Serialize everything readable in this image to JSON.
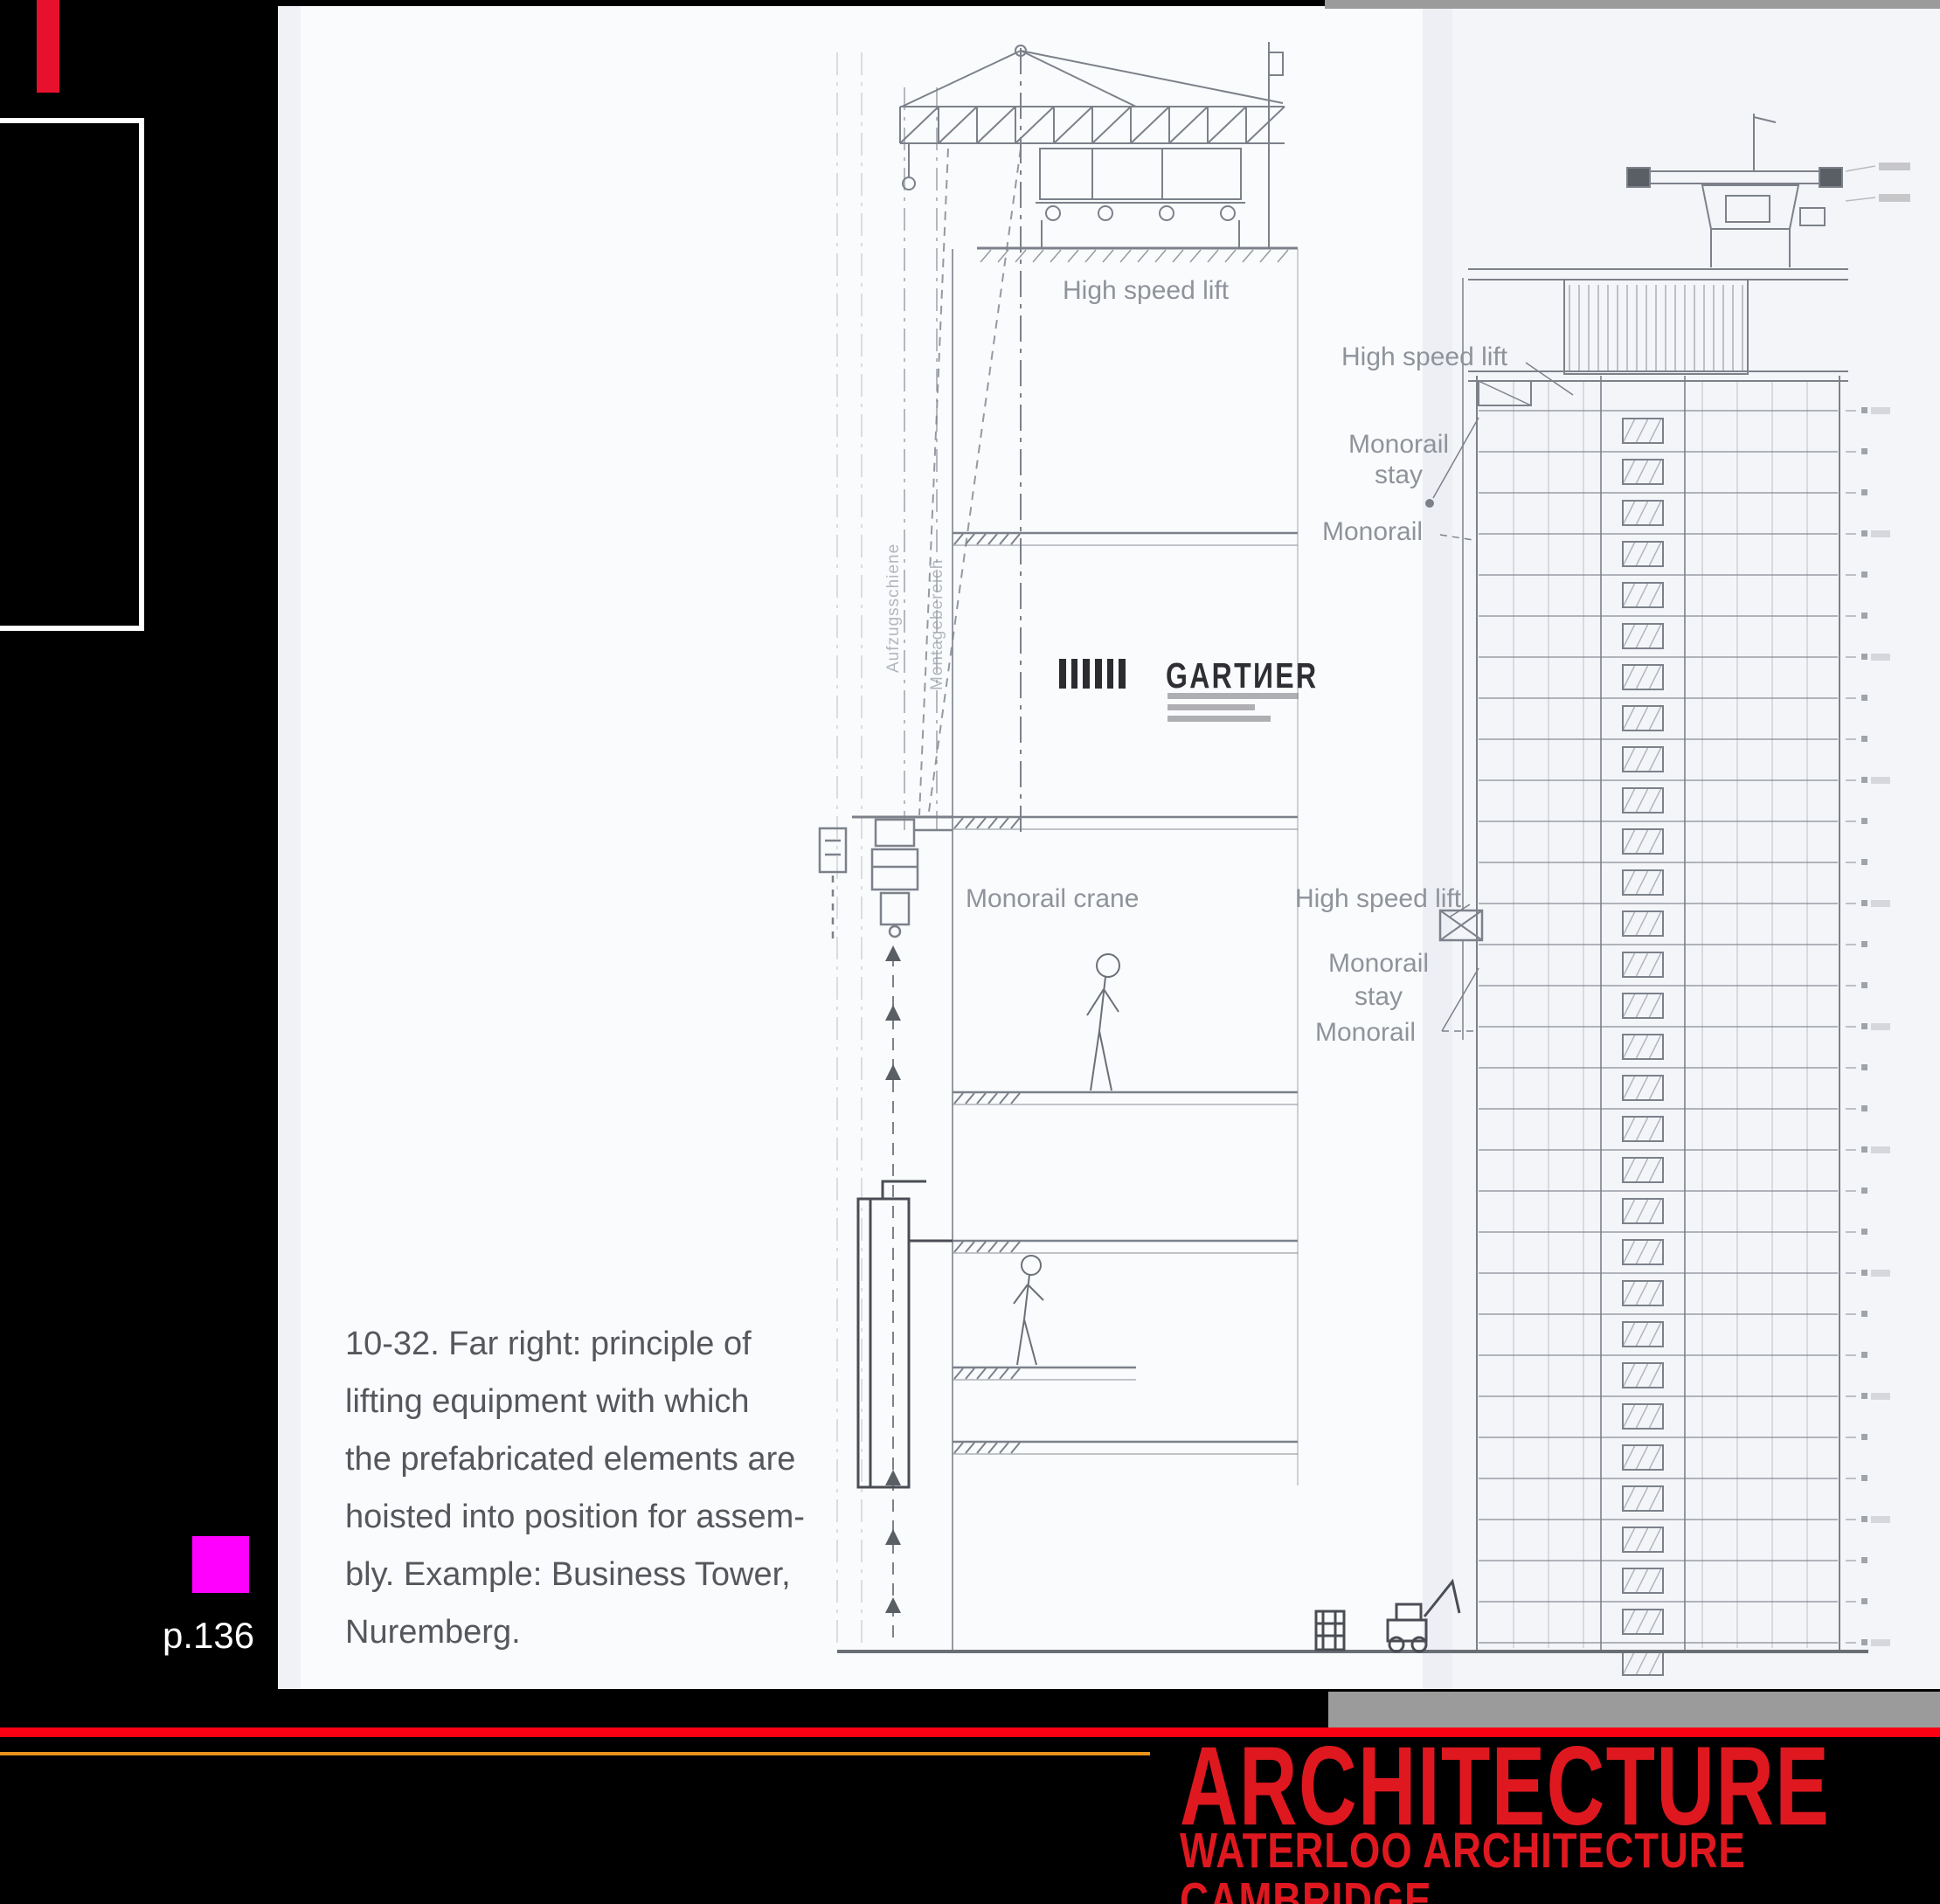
{
  "slide": {
    "background": "#000000",
    "accent_color": "#e8112d",
    "gray_bar_color": "#9b9b9b",
    "left_box_text": {
      "line1": "on",
      "line2": "ad"
    },
    "page_ref": "p.136",
    "marker_color": "#ff00ff"
  },
  "figure": {
    "caption": {
      "lines": [
        "10-32. Far right: principle of",
        "lifting equipment with which",
        "the prefabricated elements are",
        "hoisted into position for assem-",
        "bly. Example: Business Tower,",
        "Nuremberg."
      ]
    },
    "gartner_logo": {
      "text": "GARTИER"
    },
    "labels": {
      "high_speed_lift": "High speed lift",
      "monorail": "Monorail",
      "stay": "stay",
      "monorail_crane": "Monorail crane"
    },
    "vertical_labels": {
      "rail": "Aufzugsschiene",
      "zone": "Montagebereich"
    }
  },
  "footer": {
    "line1": "ARCHITECTURE",
    "line2": "WATERLOO ARCHITECTURE CAMBRIDGE",
    "text_color": "#df1820",
    "red_bar_color": "#fa0013",
    "orange_line_color": "#e8941c"
  }
}
